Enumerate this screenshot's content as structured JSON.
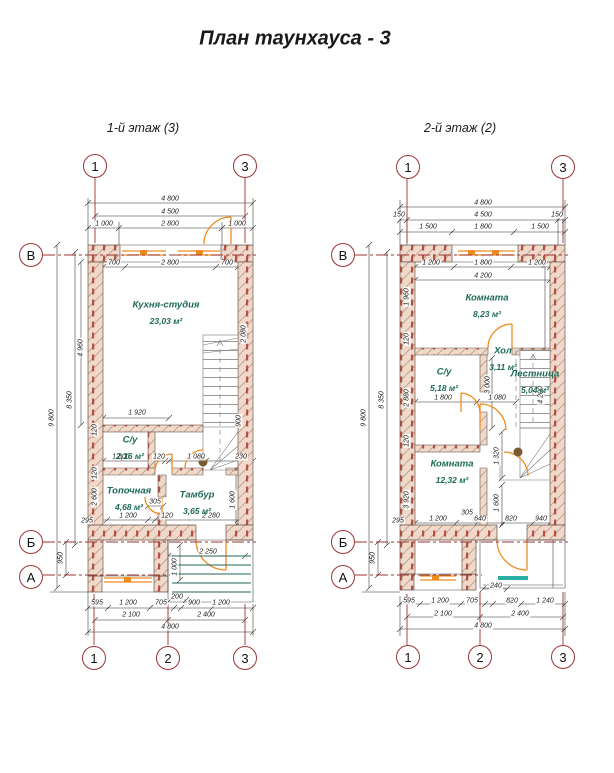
{
  "title": "План таунхауса - 3",
  "colors": {
    "axis_red": "#9b3434",
    "opening_orange": "#ef8c1f",
    "stair_teal": "#2aaea2",
    "porch_green": "#23635a",
    "room_green": "#1d6b58",
    "wall_fill": "#eed9cb",
    "wall_hatch": "#b08f7a",
    "brick_red": "#b03a2e",
    "dim_gray": "#2f2f2f"
  },
  "plans": [
    {
      "name": "1-й этаж (3)",
      "axis_bubbles": [
        {
          "label": "1",
          "x": 95,
          "y": 166
        },
        {
          "label": "3",
          "x": 245,
          "y": 166
        },
        {
          "label": "1",
          "x": 94,
          "y": 658
        },
        {
          "label": "2",
          "x": 168,
          "y": 658
        },
        {
          "label": "3",
          "x": 245,
          "y": 658
        },
        {
          "label": "В",
          "x": 31,
          "y": 255
        },
        {
          "label": "Б",
          "x": 31,
          "y": 542
        },
        {
          "label": "А",
          "x": 31,
          "y": 577
        }
      ],
      "rooms": [
        {
          "name": "Кухня-студия",
          "area": "23,03 м²",
          "x": 166,
          "y": 305
        },
        {
          "name": "С/у",
          "area": "2,16 м²",
          "x": 130,
          "y": 440
        },
        {
          "name": "Топочная",
          "area": "4,68 м²",
          "x": 129,
          "y": 491
        },
        {
          "name": "Тамбур",
          "area": "3,65 м²",
          "x": 197,
          "y": 495
        }
      ],
      "dims": [
        {
          "t": "4 800",
          "x": 170,
          "y": 199
        },
        {
          "t": "4 500",
          "x": 170,
          "y": 212
        },
        {
          "t": "1 000",
          "x": 104,
          "y": 224
        },
        {
          "t": "2 800",
          "x": 170,
          "y": 224
        },
        {
          "t": "1 000",
          "x": 237,
          "y": 224
        },
        {
          "t": "700",
          "x": 114,
          "y": 263
        },
        {
          "t": "2 800",
          "x": 170,
          "y": 263
        },
        {
          "t": "700",
          "x": 227,
          "y": 263
        },
        {
          "t": "1 920",
          "x": 137,
          "y": 413
        },
        {
          "t": "1 800",
          "x": 121,
          "y": 457
        },
        {
          "t": "120",
          "x": 159,
          "y": 457
        },
        {
          "t": "1 080",
          "x": 196,
          "y": 457
        },
        {
          "t": "230",
          "x": 241,
          "y": 457
        },
        {
          "t": "305",
          "x": 155,
          "y": 502
        },
        {
          "t": "1 200",
          "x": 128,
          "y": 516
        },
        {
          "t": "120",
          "x": 167,
          "y": 516
        },
        {
          "t": "2 280",
          "x": 211,
          "y": 516
        },
        {
          "t": "295",
          "x": 87,
          "y": 521
        },
        {
          "t": "2 250",
          "x": 208,
          "y": 552
        },
        {
          "t": "200",
          "x": 177,
          "y": 597
        },
        {
          "t": "595",
          "x": 97,
          "y": 603
        },
        {
          "t": "1 200",
          "x": 128,
          "y": 603
        },
        {
          "t": "705",
          "x": 161,
          "y": 603
        },
        {
          "t": "900",
          "x": 194,
          "y": 603
        },
        {
          "t": "1 200",
          "x": 221,
          "y": 603
        },
        {
          "t": "2 100",
          "x": 131,
          "y": 615
        },
        {
          "t": "2 400",
          "x": 206,
          "y": 615
        },
        {
          "t": "4 800",
          "x": 170,
          "y": 627
        }
      ],
      "vdims": [
        {
          "t": "9 800",
          "x": 52,
          "y": 418
        },
        {
          "t": "8 350",
          "x": 70,
          "y": 400
        },
        {
          "t": "950",
          "x": 61,
          "y": 558
        },
        {
          "t": "4 960",
          "x": 81,
          "y": 348
        },
        {
          "t": "120",
          "x": 95,
          "y": 430
        },
        {
          "t": "2 080",
          "x": 244,
          "y": 334
        },
        {
          "t": "900",
          "x": 239,
          "y": 421
        },
        {
          "t": "2 600",
          "x": 95,
          "y": 497
        },
        {
          "t": "120",
          "x": 95,
          "y": 473
        },
        {
          "t": "1 600",
          "x": 233,
          "y": 500
        },
        {
          "t": "1 000",
          "x": 175,
          "y": 567
        }
      ]
    },
    {
      "name": "2-й этаж (2)",
      "axis_bubbles": [
        {
          "label": "1",
          "x": 408,
          "y": 167
        },
        {
          "label": "3",
          "x": 563,
          "y": 167
        },
        {
          "label": "1",
          "x": 408,
          "y": 657
        },
        {
          "label": "2",
          "x": 480,
          "y": 657
        },
        {
          "label": "3",
          "x": 563,
          "y": 657
        },
        {
          "label": "В",
          "x": 343,
          "y": 255
        },
        {
          "label": "Б",
          "x": 343,
          "y": 542
        },
        {
          "label": "А",
          "x": 343,
          "y": 577
        }
      ],
      "rooms": [
        {
          "name": "Комната",
          "area": "8,23 м²",
          "x": 487,
          "y": 298
        },
        {
          "name": "С/у",
          "area": "5,18 м²",
          "x": 444,
          "y": 372
        },
        {
          "name": "Хол",
          "area": "3,11 м²",
          "x": 503,
          "y": 351
        },
        {
          "name": "Лестница",
          "area": "5,04 м²",
          "x": 535,
          "y": 374
        },
        {
          "name": "Комната",
          "area": "12,32 м²",
          "x": 452,
          "y": 464
        }
      ],
      "dims": [
        {
          "t": "4 800",
          "x": 483,
          "y": 203
        },
        {
          "t": "150",
          "x": 399,
          "y": 215
        },
        {
          "t": "4 500",
          "x": 483,
          "y": 215
        },
        {
          "t": "150",
          "x": 557,
          "y": 215
        },
        {
          "t": "1 500",
          "x": 428,
          "y": 227
        },
        {
          "t": "1 800",
          "x": 483,
          "y": 227
        },
        {
          "t": "1 500",
          "x": 540,
          "y": 227
        },
        {
          "t": "1 200",
          "x": 431,
          "y": 263
        },
        {
          "t": "1 800",
          "x": 483,
          "y": 263
        },
        {
          "t": "1 200",
          "x": 537,
          "y": 263
        },
        {
          "t": "4 200",
          "x": 483,
          "y": 276
        },
        {
          "t": "1 800",
          "x": 443,
          "y": 398
        },
        {
          "t": "1 080",
          "x": 497,
          "y": 398
        },
        {
          "t": "305",
          "x": 467,
          "y": 513
        },
        {
          "t": "1 200",
          "x": 438,
          "y": 519
        },
        {
          "t": "640",
          "x": 480,
          "y": 519
        },
        {
          "t": "820",
          "x": 511,
          "y": 519
        },
        {
          "t": "940",
          "x": 541,
          "y": 519
        },
        {
          "t": "295",
          "x": 398,
          "y": 521
        },
        {
          "t": "240",
          "x": 496,
          "y": 586
        },
        {
          "t": "595",
          "x": 409,
          "y": 601
        },
        {
          "t": "1 200",
          "x": 440,
          "y": 601
        },
        {
          "t": "705",
          "x": 472,
          "y": 601
        },
        {
          "t": "820",
          "x": 512,
          "y": 601
        },
        {
          "t": "1 240",
          "x": 545,
          "y": 601
        },
        {
          "t": "2 100",
          "x": 443,
          "y": 614
        },
        {
          "t": "2 400",
          "x": 520,
          "y": 614
        },
        {
          "t": "4 800",
          "x": 483,
          "y": 626
        }
      ],
      "vdims": [
        {
          "t": "9 800",
          "x": 364,
          "y": 418
        },
        {
          "t": "8 350",
          "x": 382,
          "y": 400
        },
        {
          "t": "950",
          "x": 373,
          "y": 558
        },
        {
          "t": "1 960",
          "x": 407,
          "y": 297
        },
        {
          "t": "120",
          "x": 407,
          "y": 339
        },
        {
          "t": "2 880",
          "x": 407,
          "y": 398
        },
        {
          "t": "120",
          "x": 407,
          "y": 441
        },
        {
          "t": "3 920",
          "x": 407,
          "y": 500
        },
        {
          "t": "3 000",
          "x": 488,
          "y": 385
        },
        {
          "t": "1 320",
          "x": 497,
          "y": 456
        },
        {
          "t": "1 600",
          "x": 497,
          "y": 503
        },
        {
          "t": "4 200",
          "x": 541,
          "y": 395
        }
      ]
    }
  ]
}
